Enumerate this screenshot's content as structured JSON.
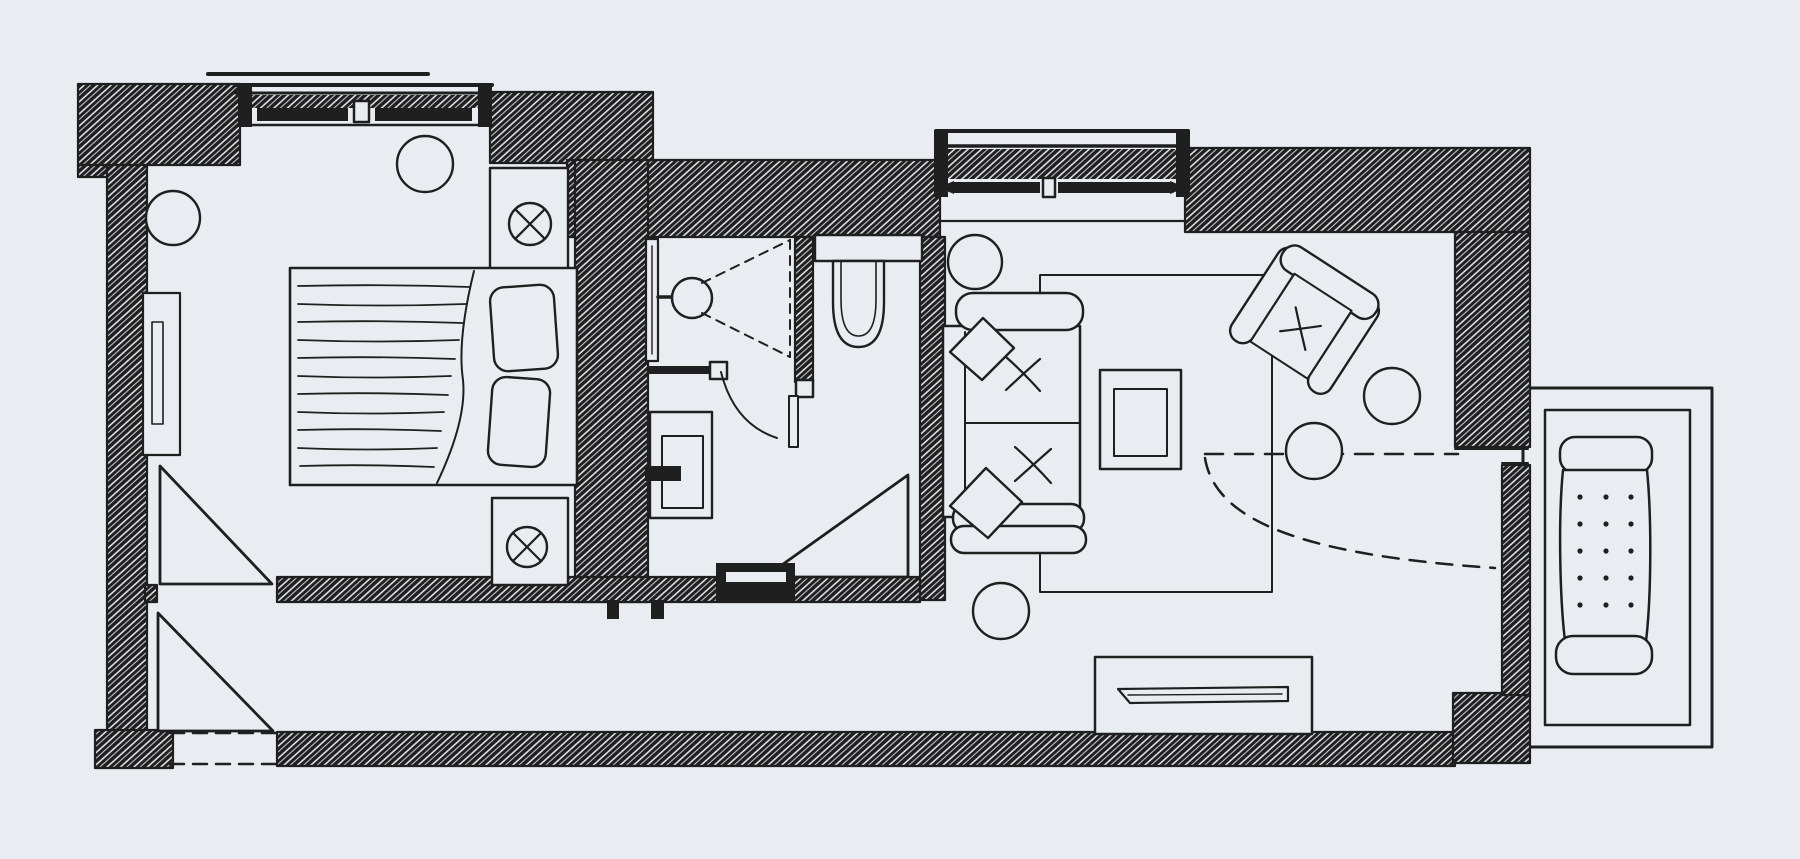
{
  "meta": {
    "type": "floor-plan-sketch",
    "description": "Hand-drawn ink floor plan of a one-bedroom suite with bedroom, hallway, bathroom, WC, living room and balcony"
  },
  "colors": {
    "background": "#e9edf2",
    "ink": "#1f1f1f"
  },
  "legend": {
    "style": "freehand ink sketch, crosshatched walls, no text labels",
    "rooms": [
      {
        "id": "bedroom",
        "items": [
          "double-bed",
          "blanket",
          "pillow x2",
          "nightstand x2",
          "table-lamp-symbol x2",
          "radiator-niche",
          "round-stool x2",
          "window-with-two-sashes",
          "door-swing-triangle"
        ]
      },
      {
        "id": "hallway",
        "items": [
          "entry-opening-dashed",
          "entry-door-swing-triangle",
          "bedroom-door-swing-triangle",
          "track-stub x2"
        ]
      },
      {
        "id": "bathroom",
        "items": [
          "shower-wall-bar",
          "shower-head",
          "shower-spray-dashed-cone",
          "vanity-sink",
          "faucet",
          "door-leaf",
          "door-arc",
          "hinge-block",
          "latch-block",
          "threshold"
        ]
      },
      {
        "id": "wc",
        "items": [
          "toilet-cistern",
          "toilet-bowl",
          "partition-wall"
        ]
      },
      {
        "id": "living-room",
        "items": [
          "sliding-window-with-arrows",
          "sofa-two-seat",
          "seat-tuft-x x2",
          "throw-pillow x2",
          "round-stool x2",
          "coffee-table",
          "armchair-rotated",
          "round-side-table x2",
          "rug",
          "tv-console",
          "tv",
          "balcony-door-dashed-swing"
        ]
      },
      {
        "id": "balcony",
        "items": [
          "railing-frame",
          "sun-lounger-dotted"
        ]
      }
    ]
  }
}
